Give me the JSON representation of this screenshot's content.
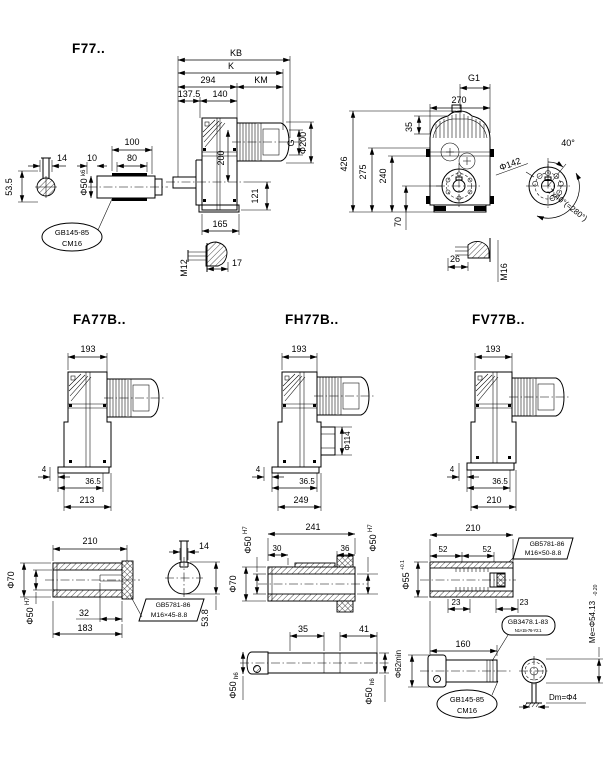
{
  "drawing": {
    "f77": {
      "title": "F77..",
      "dims": {
        "kb": "KB",
        "k": "K",
        "d294": "294",
        "km": "KM",
        "d137_5": "137.5",
        "d140": "140",
        "d100": "100",
        "d80": "80",
        "d10": "10",
        "d14": "14",
        "d53_5": "53.5",
        "shaft_dia": "Φ50",
        "shaft_fit": "k6",
        "d200": "200",
        "d121": "121",
        "d165": "165",
        "m12": "M12",
        "d17": "17",
        "g": "G",
        "dia200": "Φ200",
        "g1": "G1",
        "d270": "270",
        "d35": "35",
        "d426": "426",
        "d275": "275",
        "d240": "240",
        "d70": "70",
        "dia142": "Φ142",
        "a40": "40°",
        "a280": "7x40°(=280°)",
        "d26": "26",
        "m16": "M16"
      },
      "plug_callout": {
        "line1": "GB145-85",
        "line2": "CM16"
      }
    },
    "fa77b": {
      "title": "FA77B..",
      "dims": {
        "d193": "193",
        "d4": "4",
        "d36_5": "36.5",
        "d213": "213"
      }
    },
    "fh77b": {
      "title": "FH77B..",
      "dims": {
        "d193": "193",
        "dia114": "Φ114",
        "d4": "4",
        "d36_5": "36.5",
        "d249": "249"
      }
    },
    "fv77b": {
      "title": "FV77B..",
      "dims": {
        "d193": "193",
        "d4": "4",
        "d36_5": "36.5",
        "d210": "210"
      }
    },
    "fa_shaft": {
      "dims": {
        "d210": "210",
        "dia70": "Φ70",
        "bore": "Φ50",
        "bore_fit": "H7",
        "d32": "32",
        "d183": "183",
        "d14": "14",
        "d53_8": "53.8"
      },
      "bolt_callout": {
        "line1": "GB5781-86",
        "line2": "M16×45-8.8"
      }
    },
    "fh_shaft": {
      "dims": {
        "d241": "241",
        "bore": "Φ50",
        "bore_fit": "H7",
        "d30": "30",
        "d36": "36",
        "dia70": "Φ70",
        "d35": "35",
        "d41": "41",
        "shaft": "Φ50",
        "shaft_fit": "h6"
      }
    },
    "fv_shaft": {
      "dims": {
        "d210": "210",
        "d52": "52",
        "bore": "Φ55",
        "bore_fit": "+0.1",
        "d23": "23",
        "d160": "160",
        "me": "Me=Φ54.13",
        "me_tol": "-0.20",
        "dia62": "Φ62min",
        "dm": "Dm=Φ4"
      },
      "bolt_callout": {
        "line1": "GB5781-86",
        "line2": "M16×50-8.8"
      },
      "spline_callout": {
        "line1": "GB3478.1-83",
        "line2": "N1×15-76-Y2.1"
      },
      "plug_callout": {
        "line1": "GB145-85",
        "line2": "CM16"
      }
    }
  }
}
